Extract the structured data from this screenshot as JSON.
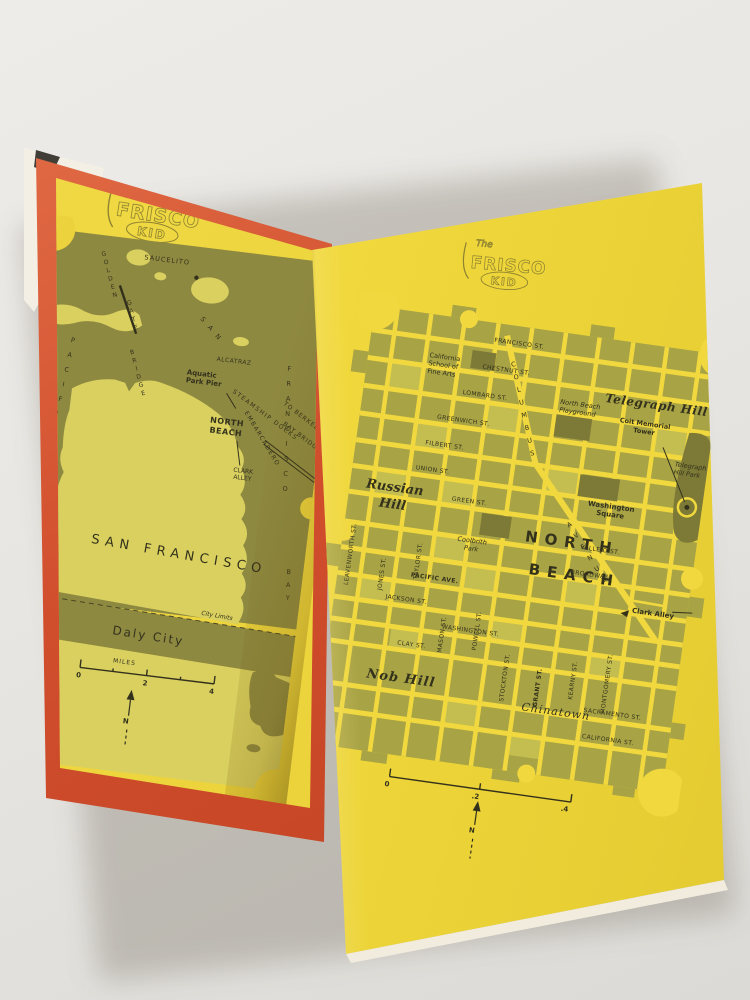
{
  "photo": {
    "background": "#e9e7e3"
  },
  "book": {
    "logo": {
      "the": "The",
      "title": "FRISCO",
      "kid": "KID"
    }
  },
  "left_map": {
    "labels": {
      "saucelito": "SAUCELITO",
      "golden": "GOLDEN",
      "gate": "GATE",
      "bridge": "BRIDGE",
      "pacific": "PACIFIC",
      "ocean": "OCEAN",
      "alcatraz": "ALCATRAZ",
      "aquatic_1": "Aquatic",
      "aquatic_2": "Park Pier",
      "steamship_docks": "STEAMSHIP DOCKS",
      "embarcadero": "EMBARCADERO",
      "bay_san": "SAN",
      "bay_francisco": "FRANCISCO",
      "bay_bay": "BAY",
      "to_berkeley": "TO BERKELEY",
      "bay_bridge": "BAY BRIDGE",
      "north_beach_1": "NORTH",
      "north_beach_2": "BEACH",
      "clark_1": "CLARK",
      "clark_2": "ALLEY",
      "san_francisco": "SAN FRANCISCO",
      "daly_city": "Daly City",
      "city_limits": "City Limits"
    },
    "scale": {
      "unit": "MILES",
      "t0": "0",
      "t1": "2",
      "t2": "4"
    },
    "compass": "N"
  },
  "right_map": {
    "streets_h": [
      "FRANCISCO ST.",
      "CHESTNUT ST.",
      "LOMBARD ST.",
      "GREENWICH ST.",
      "FILBERT ST.",
      "UNION ST.",
      "GREEN ST.",
      "VALLEJO ST.",
      "BROADWAY",
      "PACIFIC AVE.",
      "JACKSON ST.",
      "WASHINGTON ST.",
      "CLAY ST.",
      "SACRAMENTO ST.",
      "CALIFORNIA ST."
    ],
    "streets_v": [
      "LEAVENWORTH ST.",
      "JONES ST.",
      "TAYLOR ST.",
      "MASON ST.",
      "POWELL ST.",
      "STOCKTON ST.",
      "GRANT ST.",
      "KEARNY ST.",
      "MONTGOMERY ST."
    ],
    "columbus": "COLUMBUS",
    "avenue": "AVENUE",
    "places": {
      "school_1": "California",
      "school_2": "School of",
      "school_3": "Fine Arts",
      "playground_1": "North Beach",
      "playground_2": "Playground",
      "telegraph_hill": "Telegraph Hill",
      "coit_1": "Coit Memorial",
      "coit_2": "Tower",
      "telegraph_park_1": "Telegraph",
      "telegraph_park_2": "Hill Park",
      "washington_1": "Washington",
      "washington_2": "Square",
      "russian_1": "Russian",
      "russian_2": "Hill",
      "coolbrith_1": "Coolbrith",
      "coolbrith_2": "Park",
      "north_beach_1": "NORTH",
      "north_beach_2": "BEACH",
      "clark_alley": "Clark Alley",
      "nob_hill": "Nob Hill",
      "chinatown": "Chinatown"
    },
    "scale": {
      "t0": "0",
      "t1": ".2",
      "t2": ".4"
    },
    "compass": "N"
  }
}
